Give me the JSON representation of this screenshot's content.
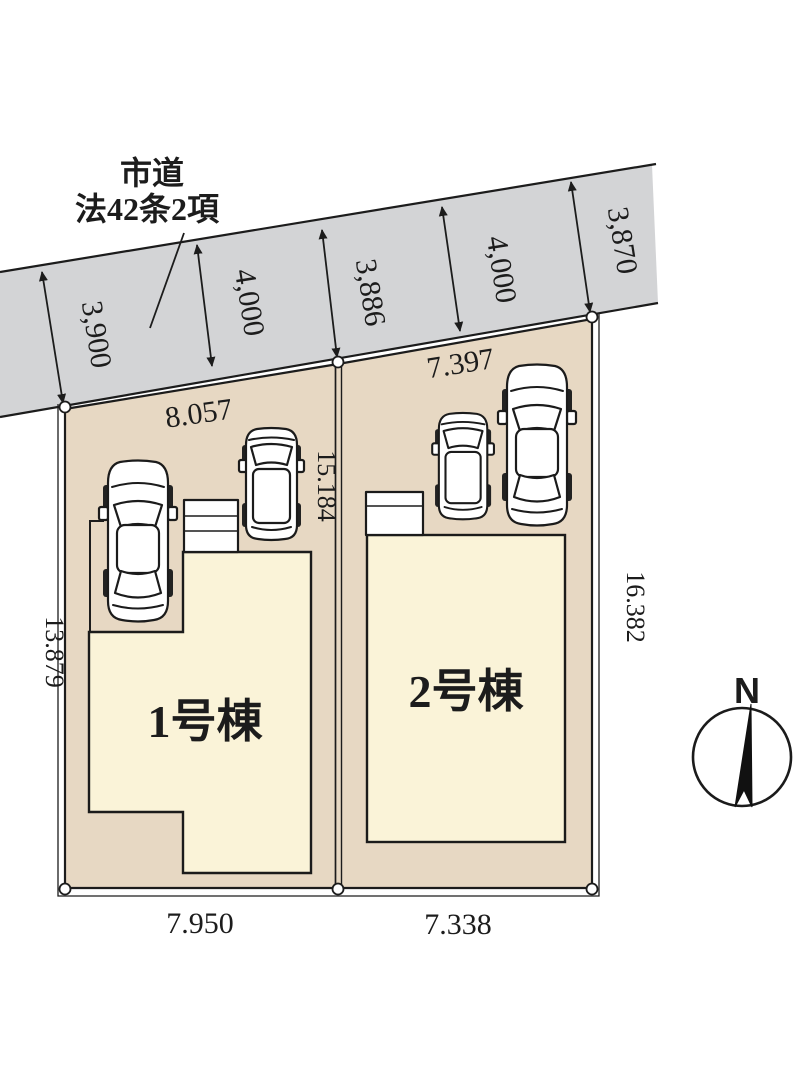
{
  "road": {
    "label_line1": "市道",
    "label_line2": "法42条2項",
    "width_dims": [
      "3,900",
      "4,000",
      "3,886",
      "4,000",
      "3,870"
    ]
  },
  "lot1": {
    "building_label": "1号棟",
    "top_dim": "8.057",
    "left_dim": "13.879",
    "divider_dim": "15.184",
    "bottom_dim": "7.950"
  },
  "lot2": {
    "building_label": "2号棟",
    "top_dim": "7.397",
    "right_dim": "16.382",
    "bottom_dim": "7.338"
  },
  "compass": {
    "label": "N"
  },
  "colors": {
    "road": "#d3d4d6",
    "lot": "#e7d8c3",
    "building": "#faf3d8",
    "line": "#1c1c1c"
  }
}
